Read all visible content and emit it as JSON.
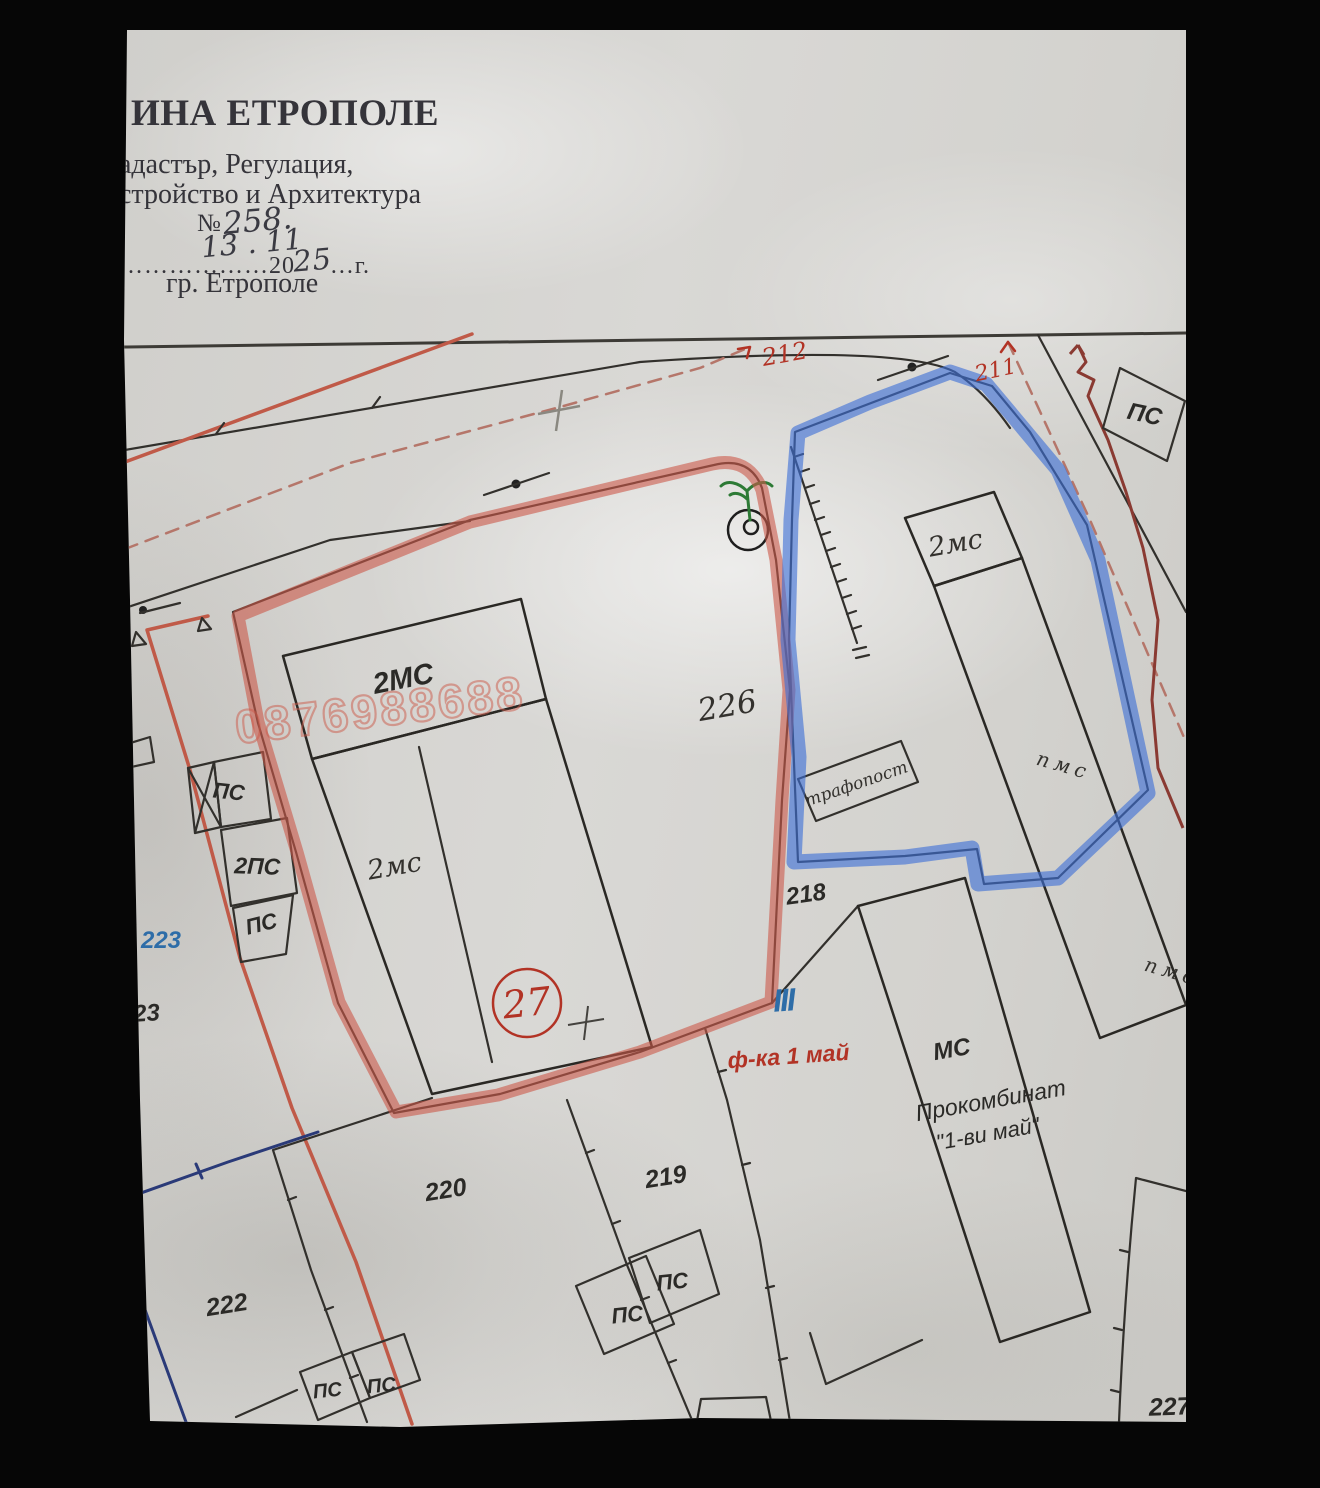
{
  "document": {
    "type": "cadastral-sketch-photo",
    "municipality_city": "Етрополе"
  },
  "header": {
    "org_line_prefix": "ИНА",
    "org_line_name": "ЕТРОПОЛЕ",
    "dept_line1": "адастър, Регулация,",
    "dept_line2": "стройство и Архитектура",
    "number_sign": "№",
    "number_value": "258.",
    "date_value": "13 . 11",
    "dots_leader": "………………",
    "year_printed": "20",
    "year_hand": "25",
    "dots_tail": "…г.",
    "city": "гр. Етрополе"
  },
  "map": {
    "labels": {
      "street_212": "212",
      "street_211": "211",
      "ps": "ПС",
      "ps2": "2ПС",
      "mc2_print": "2МС",
      "mc2_hand": "2мс",
      "pms": "пмс",
      "plot_226": "226",
      "trafopost": "трафопост",
      "plot_218": "218",
      "plot_223": "223",
      "plot_23": "23",
      "plot_27": "27",
      "roman_quarter": "III",
      "factory_label": "ф-ка 1 май",
      "mc": "МС",
      "prokombinat": "Прокомбинат",
      "may1": "\"1-ви май\"",
      "plot_220": "220",
      "plot_219": "219",
      "plot_222": "222",
      "plot_227": "227",
      "watermark_phone": "0876988688"
    },
    "colors": {
      "red_marker": "#cc5949",
      "blue_marker": "#3e6fd6",
      "red_ink": "#c05a48",
      "maroon": "#8a3a32",
      "dashed": "#b5766a",
      "navy": "#2a3a78",
      "green": "#2d7a35",
      "label_red": "#b23325",
      "blue_label": "#2e6da8"
    }
  }
}
